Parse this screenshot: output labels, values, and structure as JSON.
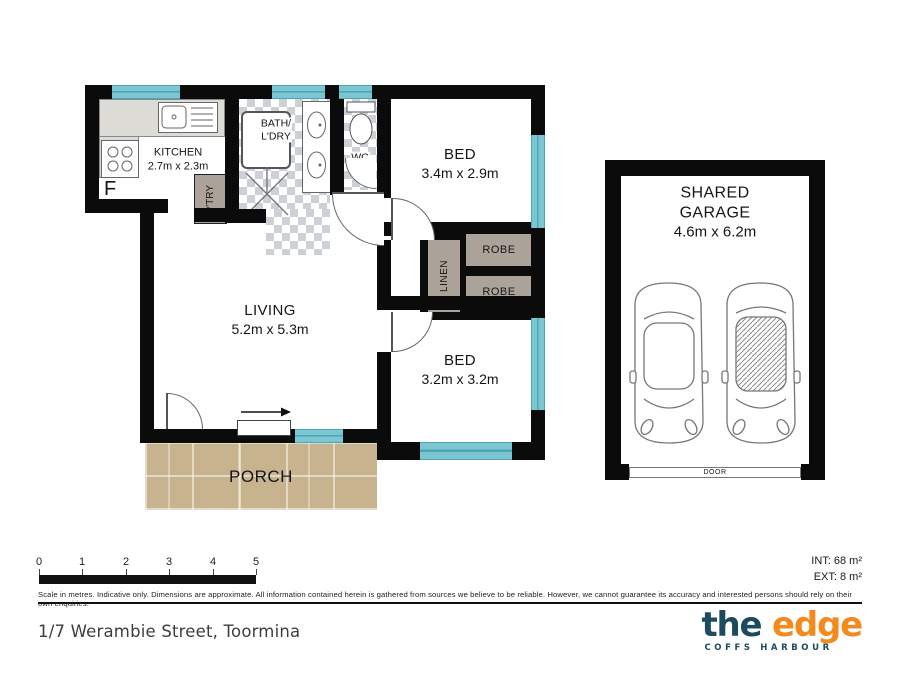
{
  "plan": {
    "rooms": {
      "kitchen": {
        "name": "KITCHEN",
        "dims": "2.7m x 2.3m"
      },
      "bath": {
        "line1": "BATH/",
        "line2": "L'DRY"
      },
      "wc": {
        "name": "WC"
      },
      "bed1": {
        "name": "BED",
        "dims": "3.4m x 2.9m"
      },
      "bed2": {
        "name": "BED",
        "dims": "3.2m x 3.2m"
      },
      "living": {
        "name": "LIVING",
        "dims": "5.2m x 5.3m"
      },
      "porch": {
        "name": "PORCH"
      },
      "garage": {
        "name_line1": "SHARED",
        "name_line2": "GARAGE",
        "dims": "4.6m x 6.2m"
      }
    },
    "fixtures": {
      "fridge": "F",
      "pantry": "P'TRY",
      "linen": "LINEN",
      "robe": "ROBE",
      "garage_door": "DOOR"
    }
  },
  "scale_bar": {
    "ticks": [
      "0",
      "1",
      "2",
      "3",
      "4",
      "5"
    ]
  },
  "areas": {
    "internal": "INT: 68 m²",
    "external": "EXT: 8 m²"
  },
  "disclaimer": "Scale in metres. Indicative only. Dimensions are approximate. All information contained herein is gathered from sources we believe to be reliable. However, we cannot guarantee its accuracy and interested persons should rely on their own enquiries.",
  "footer": {
    "address": "1/7 Werambie Street, Toormina",
    "logo": {
      "word1": "the",
      "word2": "edge",
      "tagline": "COFFS HARBOUR"
    }
  },
  "colors": {
    "wall": "#0b0b0b",
    "window": "#7cc6d2",
    "window_edge": "#4aa7b5",
    "fixture_fill": "#aba39a",
    "bench": "#dcdbd6",
    "porch": "#c7b38e",
    "checker": "#cbd1d6",
    "logo_navy": "#1c4a5e",
    "logo_orange": "#f28a1e",
    "text_dark": "#3d3d3d"
  }
}
